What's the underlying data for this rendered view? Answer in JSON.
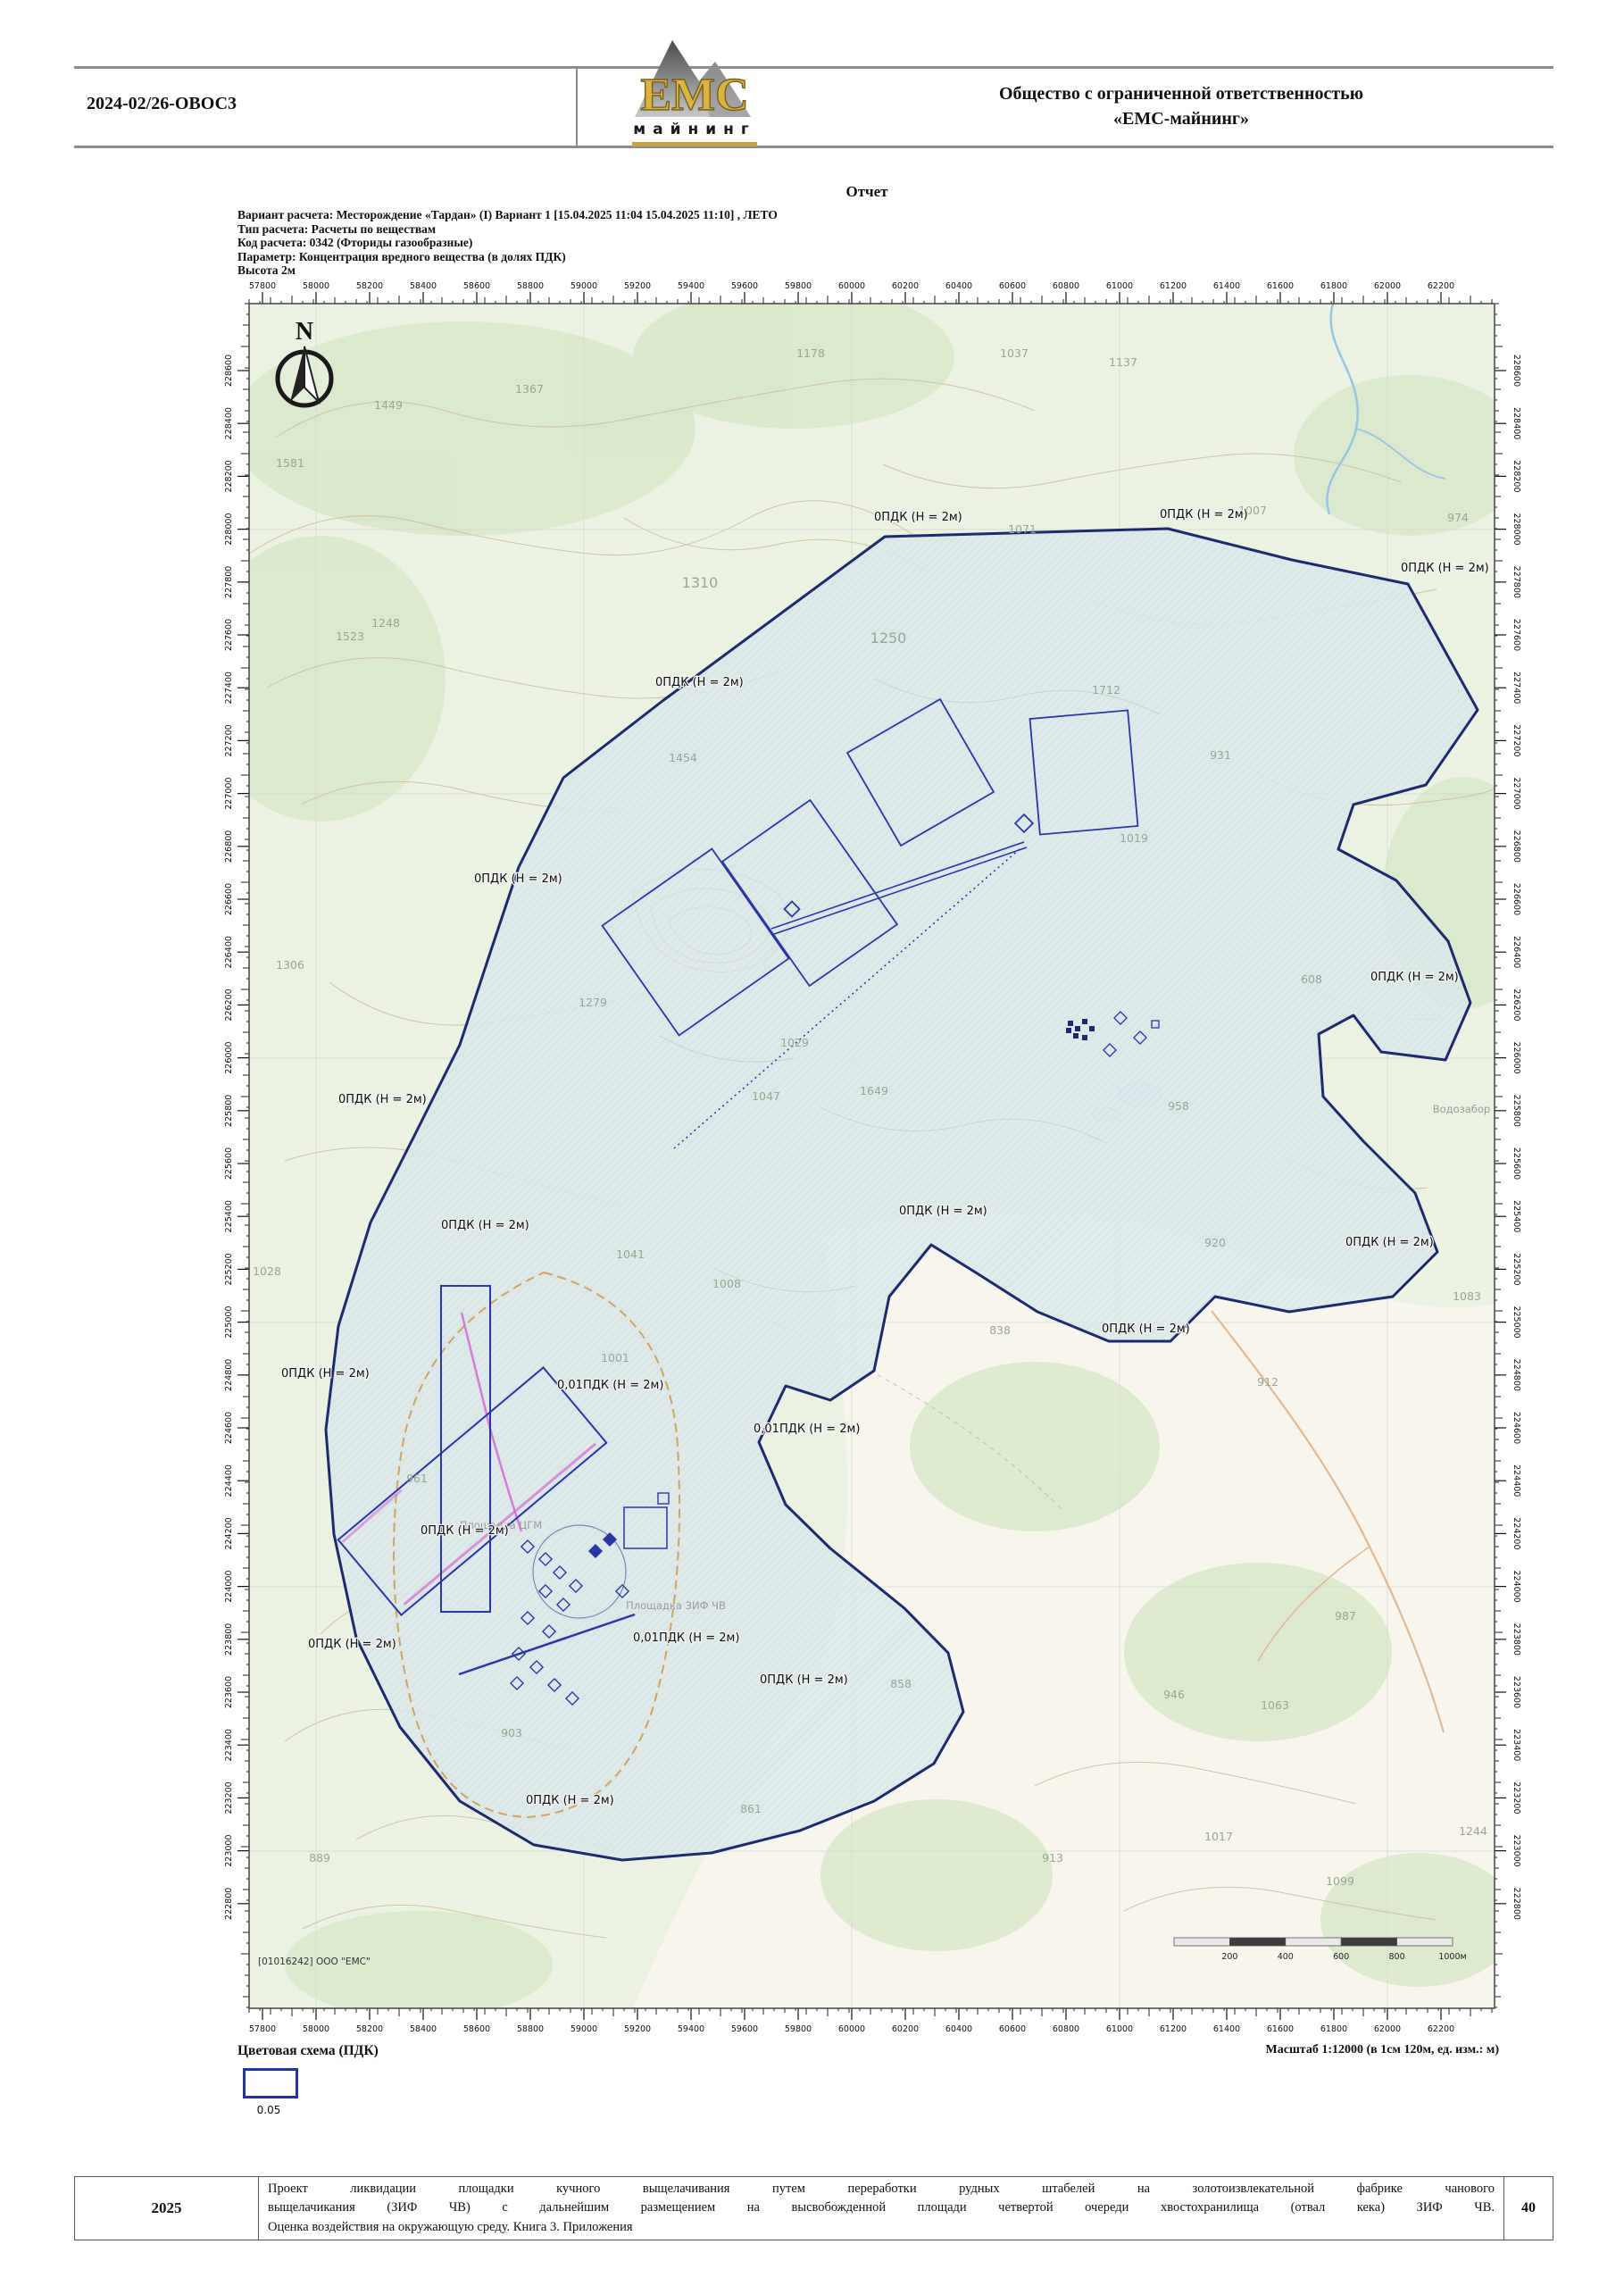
{
  "header": {
    "doc_code": "2024-02/26-ОВОС3",
    "company_line1": "Общество с ограниченной ответственностью",
    "company_line2": "«ЕМС-майнинг»",
    "logo_text": "ЕМС",
    "logo_sub": "майнинг"
  },
  "report": {
    "title": "Отчет",
    "params": [
      "Вариант расчета: Месторождение «Тардан» (I)   Вариант 1 [15.04.2025 11:04   15.04.2025 11:10] , ЛЕТО",
      "Тип расчета: Расчеты по веществам",
      "Код расчета: 0342 (Фториды газообразные)",
      "Параметр: Концентрация вредного вещества (в долях ПДК)",
      "Высота 2м"
    ]
  },
  "map": {
    "compass_label": "N",
    "credit": "[01016242] ООО \"ЕМС\"",
    "scale_text": "Масштаб 1:12000 (в 1см 120м, ед. изм.: м)",
    "x_ticks": [
      "57800",
      "58000",
      "58200",
      "58400",
      "58600",
      "58800",
      "59000",
      "59200",
      "59400",
      "59600",
      "59800",
      "60000",
      "60200",
      "60400",
      "60600",
      "60800",
      "61000",
      "61200",
      "61400",
      "61600",
      "61800",
      "62000",
      "62200"
    ],
    "y_ticks": [
      "228600",
      "228400",
      "228200",
      "228000",
      "227800",
      "227600",
      "227400",
      "227200",
      "227000",
      "226800",
      "226600",
      "226400",
      "226200",
      "226000",
      "225800",
      "225600",
      "225400",
      "225200",
      "225000",
      "224800",
      "224600",
      "224400",
      "224200",
      "224000",
      "223800",
      "223600",
      "223400",
      "223200",
      "223000",
      "222800"
    ],
    "scalebar_labels": [
      "200",
      "400",
      "600",
      "800",
      "1000м"
    ],
    "isoline_labels": [
      {
        "text": "0ПДК (Н = 2м)",
        "x": 700,
        "y": 243
      },
      {
        "text": "0ПДК (Н = 2м)",
        "x": 1020,
        "y": 240
      },
      {
        "text": "0ПДК (Н = 2м)",
        "x": 1290,
        "y": 300
      },
      {
        "text": "0ПДК (Н = 2м)",
        "x": 455,
        "y": 428
      },
      {
        "text": "0ПДК (Н = 2м)",
        "x": 252,
        "y": 648
      },
      {
        "text": "0ПДК (Н = 2м)",
        "x": 1256,
        "y": 758
      },
      {
        "text": "0ПДК (Н = 2м)",
        "x": 100,
        "y": 895
      },
      {
        "text": "0ПДК (Н = 2м)",
        "x": 215,
        "y": 1036
      },
      {
        "text": "0ПДК (Н = 2м)",
        "x": 728,
        "y": 1020
      },
      {
        "text": "0ПДК (Н = 2м)",
        "x": 1228,
        "y": 1055
      },
      {
        "text": "0ПДК (Н = 2м)",
        "x": 955,
        "y": 1152
      },
      {
        "text": "0ПДК (Н = 2м)",
        "x": 36,
        "y": 1202
      },
      {
        "text": "0,01ПДК (Н = 2м)",
        "x": 345,
        "y": 1215
      },
      {
        "text": "0,01ПДК (Н = 2м)",
        "x": 565,
        "y": 1264
      },
      {
        "text": "0ПДК (Н = 2м)",
        "x": 192,
        "y": 1378
      },
      {
        "text": "0,01ПДК (Н = 2м)",
        "x": 430,
        "y": 1498
      },
      {
        "text": "0ПДК (Н = 2м)",
        "x": 572,
        "y": 1545
      },
      {
        "text": "0ПДК (Н = 2м)",
        "x": 66,
        "y": 1505
      },
      {
        "text": "0ПДК (Н = 2м)",
        "x": 310,
        "y": 1680
      }
    ],
    "elevation_labels": [
      {
        "v": "1178",
        "x": 629,
        "y": 60
      },
      {
        "v": "1037",
        "x": 857,
        "y": 60
      },
      {
        "v": "1137",
        "x": 979,
        "y": 70
      },
      {
        "v": "1449",
        "x": 156,
        "y": 118
      },
      {
        "v": "1367",
        "x": 314,
        "y": 100
      },
      {
        "v": "1581",
        "x": 46,
        "y": 183
      },
      {
        "v": "1007",
        "x": 1124,
        "y": 236
      },
      {
        "v": "974",
        "x": 1354,
        "y": 244
      },
      {
        "v": "1071",
        "x": 866,
        "y": 257
      },
      {
        "v": "1248",
        "x": 153,
        "y": 362
      },
      {
        "v": "1523",
        "x": 113,
        "y": 377
      },
      {
        "v": "1310",
        "x": 505,
        "y": 318
      },
      {
        "v": "1250",
        "x": 716,
        "y": 380
      },
      {
        "v": "1712",
        "x": 960,
        "y": 437
      },
      {
        "v": "931",
        "x": 1088,
        "y": 510
      },
      {
        "v": "1454",
        "x": 486,
        "y": 513
      },
      {
        "v": "1019",
        "x": 991,
        "y": 603
      },
      {
        "v": "1306",
        "x": 46,
        "y": 745
      },
      {
        "v": "1279",
        "x": 385,
        "y": 787
      },
      {
        "v": "608",
        "x": 1190,
        "y": 761
      },
      {
        "v": "1029",
        "x": 611,
        "y": 832
      },
      {
        "v": "1047",
        "x": 579,
        "y": 892
      },
      {
        "v": "1649",
        "x": 700,
        "y": 886
      },
      {
        "v": "958",
        "x": 1041,
        "y": 903
      },
      {
        "v": "1028",
        "x": 20,
        "y": 1088
      },
      {
        "v": "1041",
        "x": 427,
        "y": 1069
      },
      {
        "v": "1008",
        "x": 535,
        "y": 1102
      },
      {
        "v": "920",
        "x": 1082,
        "y": 1056
      },
      {
        "v": "1083",
        "x": 1364,
        "y": 1116
      },
      {
        "v": "838",
        "x": 841,
        "y": 1154
      },
      {
        "v": "1001",
        "x": 410,
        "y": 1185
      },
      {
        "v": "912",
        "x": 1141,
        "y": 1212
      },
      {
        "v": "961",
        "x": 188,
        "y": 1320
      },
      {
        "v": "987",
        "x": 1228,
        "y": 1474
      },
      {
        "v": "858",
        "x": 730,
        "y": 1550
      },
      {
        "v": "946",
        "x": 1036,
        "y": 1562
      },
      {
        "v": "1063",
        "x": 1149,
        "y": 1574
      },
      {
        "v": "903",
        "x": 294,
        "y": 1605
      },
      {
        "v": "861",
        "x": 562,
        "y": 1690
      },
      {
        "v": "889",
        "x": 79,
        "y": 1745
      },
      {
        "v": "913",
        "x": 900,
        "y": 1745
      },
      {
        "v": "1017",
        "x": 1086,
        "y": 1721
      },
      {
        "v": "1244",
        "x": 1371,
        "y": 1715
      },
      {
        "v": "1099",
        "x": 1222,
        "y": 1771
      }
    ],
    "feature_labels": [
      {
        "text": "Водозабор",
        "x": 1358,
        "y": 906
      },
      {
        "text": "Площадка ЦГМ",
        "x": 282,
        "y": 1372
      },
      {
        "text": "Площадка ЗИФ ЧВ",
        "x": 478,
        "y": 1462
      }
    ],
    "colors": {
      "zone_fill": "#dbe8eb",
      "zone_stroke": "#1c2a6f",
      "site_stroke": "#2936a8",
      "contour": "#d2c1a0",
      "boundary_dashed": "#d2a35b",
      "magenta": "#d75fd0"
    }
  },
  "legend": {
    "title": "Цветовая схема (ПДК)",
    "value": "0.05"
  },
  "footer": {
    "year": "2025",
    "page": "40",
    "lines": [
      "Проект ликвидации площадки кучного выщелачивания путем переработки рудных штабелей на золотоизвлекательной фабрике чанового",
      "выщелачикания (ЗИФ ЧВ) с дальнейшим размещением на высвобожденной площади четвертой очереди хвостохранилища (отвал кека) ЗИФ ЧВ.",
      "Оценка воздействия на окружающую среду. Книга 3. Приложения"
    ]
  }
}
